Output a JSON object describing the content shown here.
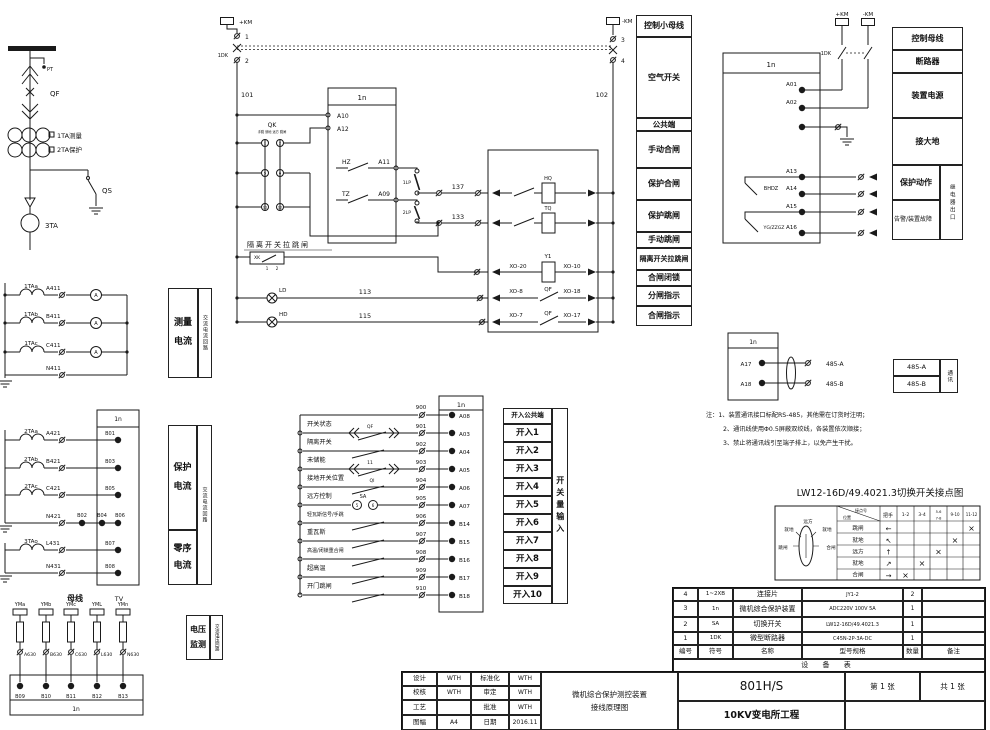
{
  "sl": {
    "pt": "PT",
    "qf": "QF",
    "ta1": "1TA测量",
    "ta2": "2TA保护",
    "qs": "QS",
    "ta3": "3TA"
  },
  "ctrl": {
    "kmp": "+KM",
    "kmn": "-KM",
    "n1": "1",
    "n2": "2",
    "n3": "3",
    "n4": "4",
    "dk": "1DK",
    "w101": "101",
    "w102": "102",
    "qk": "QK",
    "qkcap": "手跳 就地 远方 跳闸",
    "q1": "1",
    "q2": "2",
    "q5": "5",
    "q6": "6",
    "q11": "11",
    "q12": "12",
    "box": "1n",
    "a10": "A10",
    "a12": "A12",
    "hz": "HZ",
    "a11": "A11",
    "tz": "TZ",
    "a09": "A09",
    "lp1": "1LP",
    "lp2": "2LP",
    "w137": "137",
    "w133": "133",
    "iso": "隔离开关拉跳闸",
    "xk": "XK",
    "xk1": "1",
    "xk2": "2",
    "ld": "LD",
    "hd": "HD",
    "w113": "113",
    "w115": "115",
    "hq": "HQ",
    "tq": "TQ",
    "y1": "Y1",
    "xo20": "XO-20",
    "xo10": "XO-10",
    "xo8": "XO-8",
    "xo18": "XO-18",
    "xo7": "XO-7",
    "xo17": "XO-17",
    "qfa": "QF",
    "qfb": "QF"
  },
  "leg1": [
    "控制小母线",
    "空气开关",
    "公共端",
    "手动合闸",
    "保护合闸",
    "保护跳闸",
    "手动跳闸",
    "隔离开关拉跳闸",
    "合闸闭锁",
    "分闸指示",
    "合闸指示"
  ],
  "pwr": {
    "box": "1n",
    "kmp": "+KM",
    "kmn": "-KM",
    "dk": "1DK",
    "a01": "A01",
    "a02": "A02",
    "a13": "A13",
    "a14": "A14",
    "a15": "A15",
    "a16": "A16",
    "bhdz": "BHDZ",
    "yg": "YG/ZZGZ"
  },
  "leg2": {
    "r0": "控制母线",
    "r1": "断路器",
    "r2": "装置电源",
    "r3": "接大地",
    "r4": "保护动作",
    "r5": "告警/装置故障",
    "side": "继电器出口"
  },
  "comm": {
    "box": "1n",
    "a17": "A17",
    "a18": "A18",
    "wa": "485-A",
    "wb": "485-B",
    "ta": "485-A",
    "tb": "485-B",
    "side": "通讯"
  },
  "notes": {
    "head": "注：",
    "l1": "1、装置通讯接口标配RS-485，其他需在订货时注明；",
    "l2": "2、通讯线使用Φ0.5屏蔽双绞线，各装置依次顺接；",
    "l3": "3、禁止将通讯线引至端子排上，以免产生干扰。"
  },
  "lw12": {
    "title": "LW12-16D/49.4021.3切换开关接点图",
    "ca": "接点号",
    "cb": "位置",
    "handle": "把手",
    "c1": "1-2",
    "c2": "3-4",
    "c3a": "5-6",
    "c3b": "7-8",
    "c4": "9-10",
    "c5": "11-12",
    "p0": "跳闸",
    "p1": "就地",
    "p2": "远方",
    "p3": "就地",
    "p4": "合闸",
    "a0": "←",
    "a1": "↖",
    "a2": "↑",
    "a3": "↗",
    "a4": "→",
    "x": "×",
    "dtop": "远方",
    "dtl": "就地",
    "dtr": "就地",
    "dl": "跳闸",
    "dr": "合闸"
  },
  "bom": {
    "h": [
      "编号",
      "符号",
      "名称",
      "型号规格",
      "数量",
      "备注"
    ],
    "r": [
      [
        "4",
        "1~2XB",
        "连接片",
        "JY1-2",
        "2",
        ""
      ],
      [
        "3",
        "1n",
        "微机综合保护装置",
        "ADC220V 100V 5A",
        "1",
        ""
      ],
      [
        "2",
        "SA",
        "切换开关",
        "LW12-16D/49.4021.3",
        "1",
        ""
      ],
      [
        "1",
        "1DK",
        "微型断路器",
        "C45N-2P-3A-DC",
        "1",
        ""
      ]
    ],
    "cap": "设 备 表"
  },
  "tb": {
    "c": [
      [
        "设计",
        "WTH",
        "标准化",
        "WTH"
      ],
      [
        "校核",
        "WTH",
        "审定",
        "WTH"
      ],
      [
        "工艺",
        "",
        "批准",
        "WTH"
      ],
      [
        "图幅",
        "A4",
        "日期",
        "2016.11"
      ]
    ],
    "t1": "微机综合保护测控装置",
    "t2": "接线原理图",
    "model": "801H/S",
    "proj": "10KV变电所工程",
    "sheet": "第 1 张",
    "total": "共 1 张"
  },
  "meas": {
    "ct": [
      "1TAa",
      "1TAb",
      "1TAc"
    ],
    "w": [
      "A411",
      "B411",
      "C411",
      "N411"
    ],
    "m": "A",
    "l1": "测量",
    "l2": "电流",
    "side": "交流电流回路"
  },
  "prot": {
    "box": "1n",
    "ct": [
      "2TAa",
      "2TAb",
      "2TAc",
      "3TAo"
    ],
    "w": [
      "A421",
      "B421",
      "C421",
      "N421",
      "L431",
      "N431"
    ],
    "t": [
      "B01",
      "B03",
      "B05",
      "B02",
      "B04",
      "B06",
      "B07",
      "B08"
    ],
    "l1a": "保护",
    "l1b": "电流",
    "l2a": "零序",
    "l2b": "电流",
    "side": "交流电流回路"
  },
  "volt": {
    "bus": "母线",
    "tv": "TV",
    "f": [
      "YMa",
      "YMb",
      "YMc",
      "YML",
      "YMn"
    ],
    "w": [
      "A630",
      "B630",
      "C630",
      "L630",
      "N630"
    ],
    "t": [
      "B09",
      "B10",
      "B11",
      "B12",
      "B13"
    ],
    "box": "1n",
    "l1": "电压",
    "l2": "监测",
    "side": "交流电压回路"
  },
  "di": {
    "box": "1n",
    "cw": "900",
    "ctm": "A08",
    "lab": [
      "开关状态",
      "隔离开关",
      "未储能",
      "接地开关位置",
      "远方控制",
      "轻瓦斯信号/手跳",
      "重瓦斯",
      "高温/闭锁重合闸",
      "超高温",
      "开门跳闸"
    ],
    "w": [
      "901",
      "902",
      "903",
      "904",
      "905",
      "906",
      "907",
      "908",
      "909",
      "910"
    ],
    "t": [
      "A03",
      "A04",
      "A05",
      "A06",
      "A07",
      "B14",
      "B15",
      "B16",
      "B17",
      "B18"
    ],
    "qf": "QF",
    "k11": "11",
    "qi": "QI",
    "sa": "SA",
    "s5": "5",
    "s6": "6",
    "head": "开入公共端",
    "rows": [
      "开入1",
      "开入2",
      "开入3",
      "开入4",
      "开入5",
      "开入6",
      "开入7",
      "开入8",
      "开入9",
      "开入10"
    ],
    "side": "开关量输入"
  }
}
